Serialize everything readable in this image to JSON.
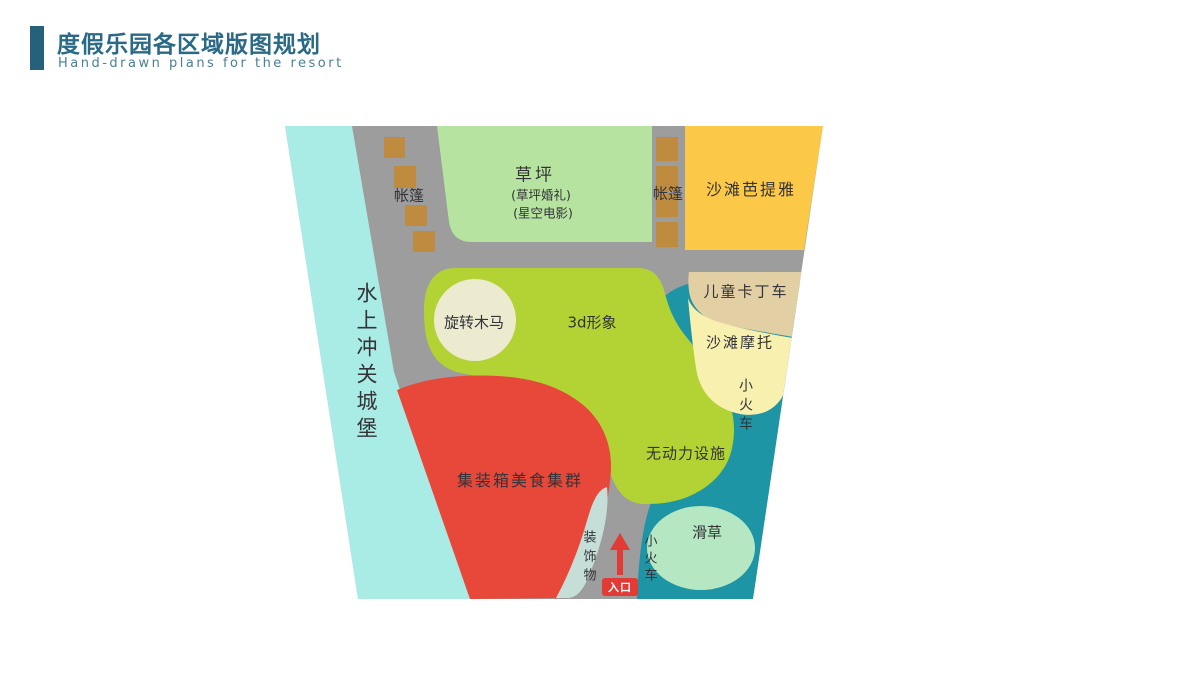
{
  "header": {
    "title": "度假乐园各区域版图规划",
    "subtitle": "Hand-drawn plans for the resort",
    "accent_color": "#26617c",
    "title_color": "#2b6a87"
  },
  "map": {
    "path_color": "#9d9d9d",
    "zones": {
      "water_castle": {
        "label": "水上冲关城堡",
        "color": "#a9ebe5"
      },
      "lawn": {
        "label": "草坪",
        "sub1": "(草坪婚礼)",
        "sub2": "(星空电影)",
        "color": "#b7e3a1"
      },
      "tents_left": {
        "label": "帐篷",
        "color": "#bf8c3f"
      },
      "tents_right": {
        "label": "帐篷",
        "color": "#bf8c3f"
      },
      "beach_pattaya": {
        "label": "沙滩芭提雅",
        "color": "#fcc847"
      },
      "kids_karting": {
        "label": "儿童卡丁车",
        "color": "#e3cfa4"
      },
      "beach_moto": {
        "label": "沙滩摩托",
        "color": "#f8f0af"
      },
      "train": {
        "label": "小火车",
        "color": "#1e95a4"
      },
      "train_bottom": {
        "label": "小火车"
      },
      "carousel": {
        "label": "旋转木马",
        "color": "#eceacf"
      },
      "attraction_3d": {
        "label": "3d形象",
        "color": "#b3d334"
      },
      "non_powered": {
        "label": "无动力设施"
      },
      "grass_skiing": {
        "label": "滑草",
        "color": "#b5e7c3"
      },
      "container_food": {
        "label": "集装箱美食集群",
        "color": "#e8483a"
      },
      "decorations": {
        "label": "装饰物",
        "color": "#c6ded8"
      }
    },
    "entrance": {
      "label": "入口",
      "color": "#e23a34",
      "arrow_icon": "up-arrow"
    }
  }
}
